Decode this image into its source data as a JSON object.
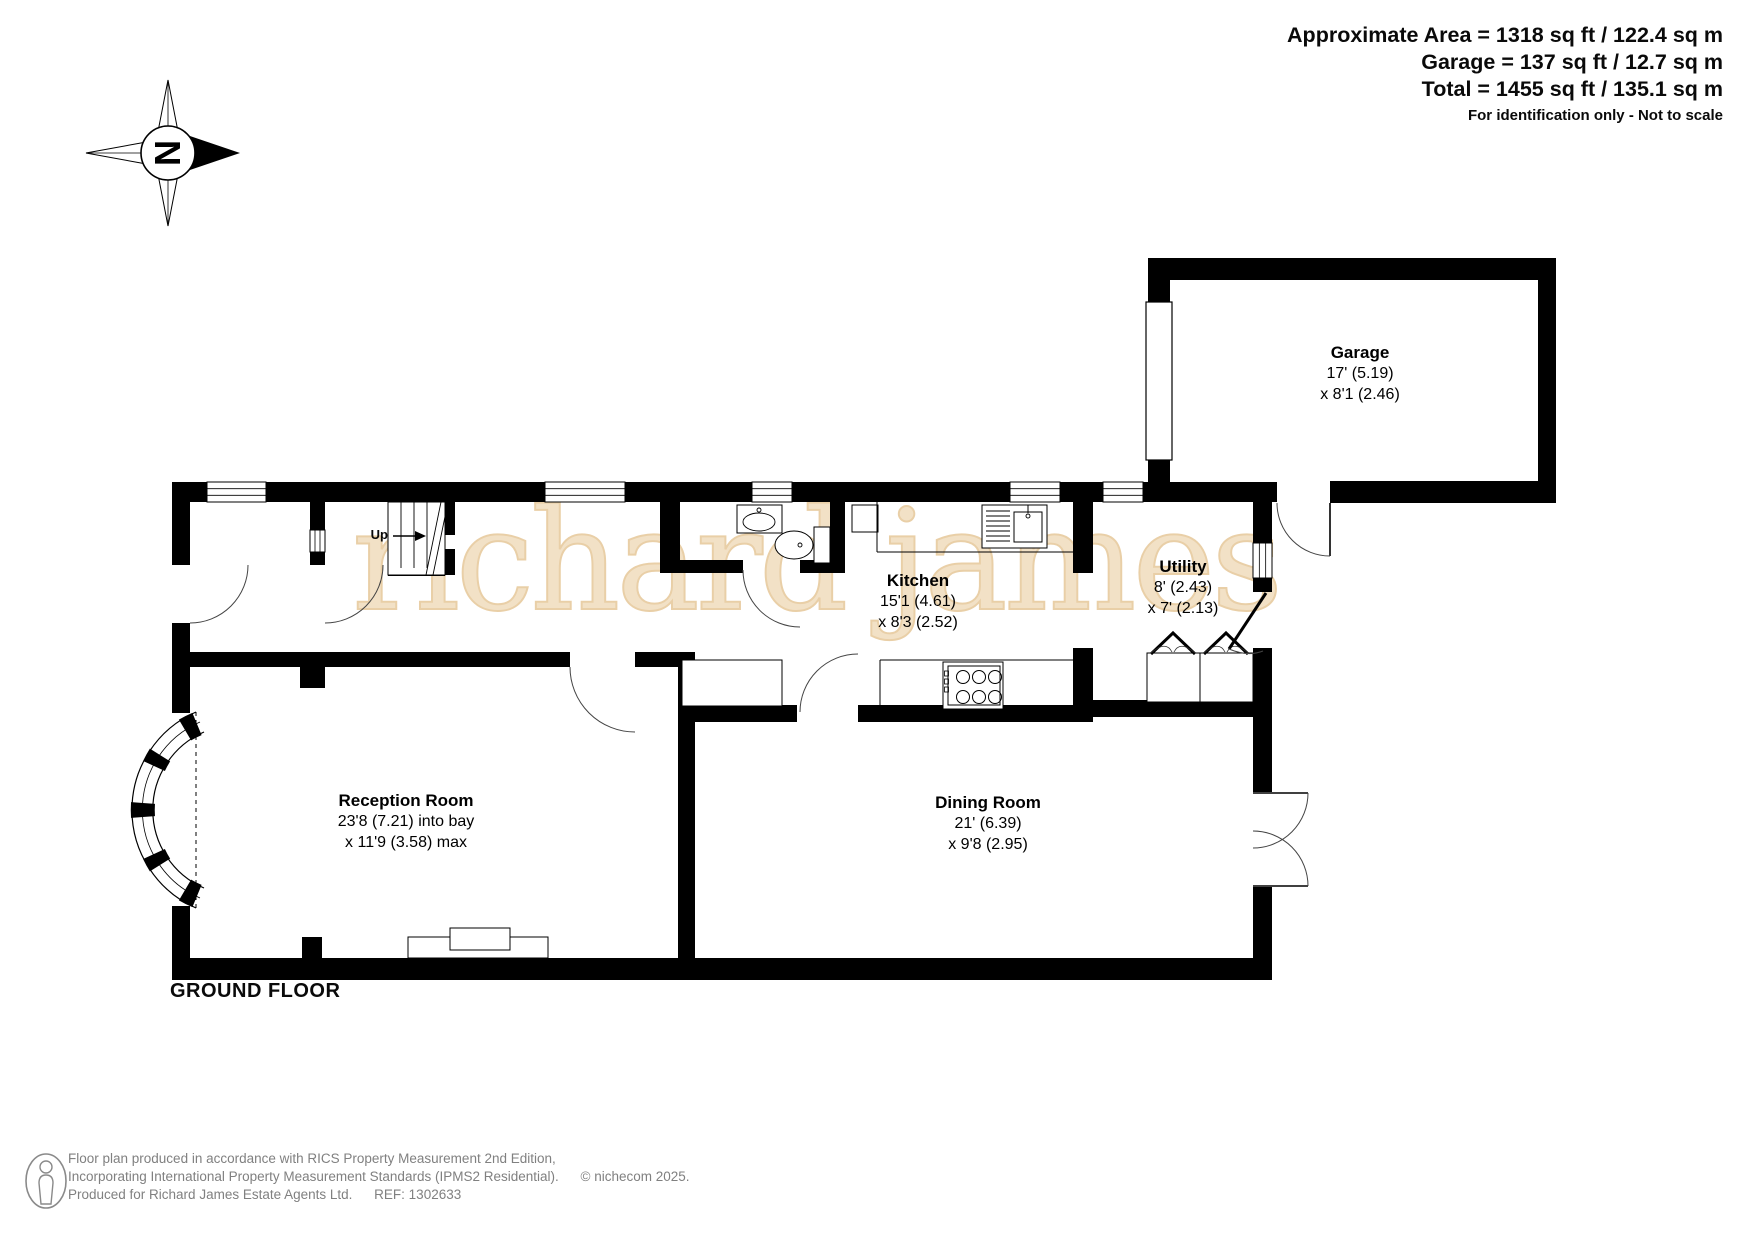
{
  "header": {
    "line1": "Approximate Area = 1318 sq ft / 122.4 sq m",
    "line2": "Garage = 137 sq ft / 12.7 sq m",
    "line3": "Total = 1455 sq ft / 135.1 sq m",
    "note": "For identification only - Not to scale"
  },
  "compass": {
    "north": "N"
  },
  "watermark": {
    "text": "richard james"
  },
  "plan": {
    "floor_label": "GROUND FLOOR",
    "stairs_label": "Up"
  },
  "rooms": {
    "garage": {
      "name": "Garage",
      "dim1": "17' (5.19)",
      "dim2": "x 8'1 (2.46)"
    },
    "kitchen": {
      "name": "Kitchen",
      "dim1": "15'1 (4.61)",
      "dim2": "x 8'3 (2.52)"
    },
    "utility": {
      "name": "Utility",
      "dim1": "8' (2.43)",
      "dim2": "x 7' (2.13)"
    },
    "reception": {
      "name": "Reception Room",
      "dim1": "23'8 (7.21) into bay",
      "dim2": "x 11'9 (3.58) max"
    },
    "dining": {
      "name": "Dining Room",
      "dim1": "21' (6.39)",
      "dim2": "x 9'8 (2.95)"
    }
  },
  "footer": {
    "line1": "Floor plan produced in accordance with RICS Property Measurement 2nd Edition,",
    "line2": "Incorporating International Property Measurement Standards (IPMS2 Residential).",
    "copyright": "© nichecom 2025.",
    "line3a": "Produced for Richard James Estate Agents Ltd.",
    "ref": "REF: 1302633"
  },
  "colors": {
    "wall": "#000000",
    "watermark": "#f2e0c4",
    "footer_text": "#808080"
  }
}
